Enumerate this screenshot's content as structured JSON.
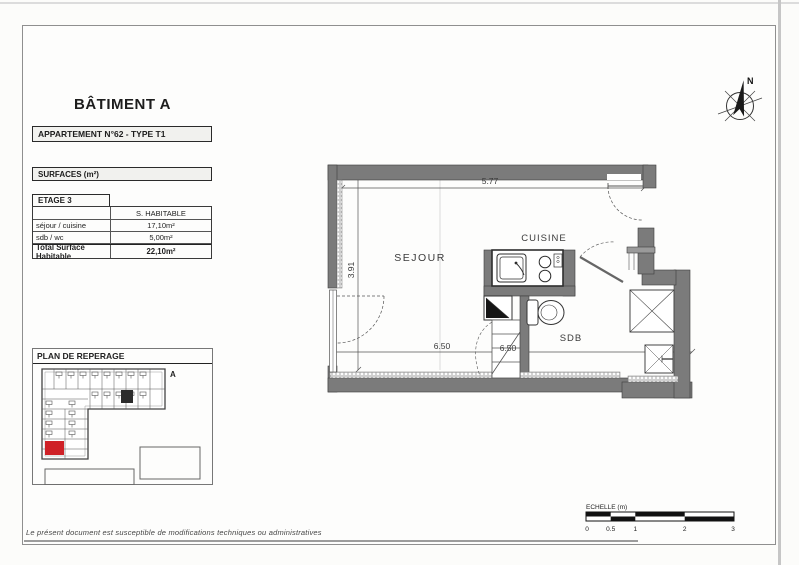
{
  "document": {
    "building_title": "BÂTIMENT A",
    "apartment_label": "APPARTEMENT N°62 - TYPE T1",
    "footer_note": "Le présent document est susceptible de modifications techniques ou administratives"
  },
  "surfaces": {
    "section_title": "SURFACES (m²)",
    "floor_label": "ETAGE 3",
    "column_header": "S. HABITABLE",
    "rows": [
      {
        "label": "séjour / cuisine",
        "value": "17,10m²"
      },
      {
        "label": "sdb / wc",
        "value": "5,00m²"
      }
    ],
    "total": {
      "label": "Total Surface Habitable",
      "value": "22,10m²"
    }
  },
  "plan_reperage": {
    "title": "PLAN DE REPERAGE",
    "building_letter": "A",
    "highlight_color": "#cf2127"
  },
  "floor_plan": {
    "rooms": {
      "sejour": "SEJOUR",
      "cuisine": "CUISINE",
      "sdb": "SDB"
    },
    "dimensions": {
      "top": "5.77",
      "left": "3.91",
      "bottom_left": "6.50",
      "bottom_right": "6.50"
    },
    "wall_color": "#7b7b7b"
  },
  "compass": {
    "north_label": "N"
  },
  "scale_bar": {
    "label": "ECHELLE (m)",
    "ticks": [
      "0",
      "0.5",
      "1",
      "2",
      "3"
    ]
  }
}
